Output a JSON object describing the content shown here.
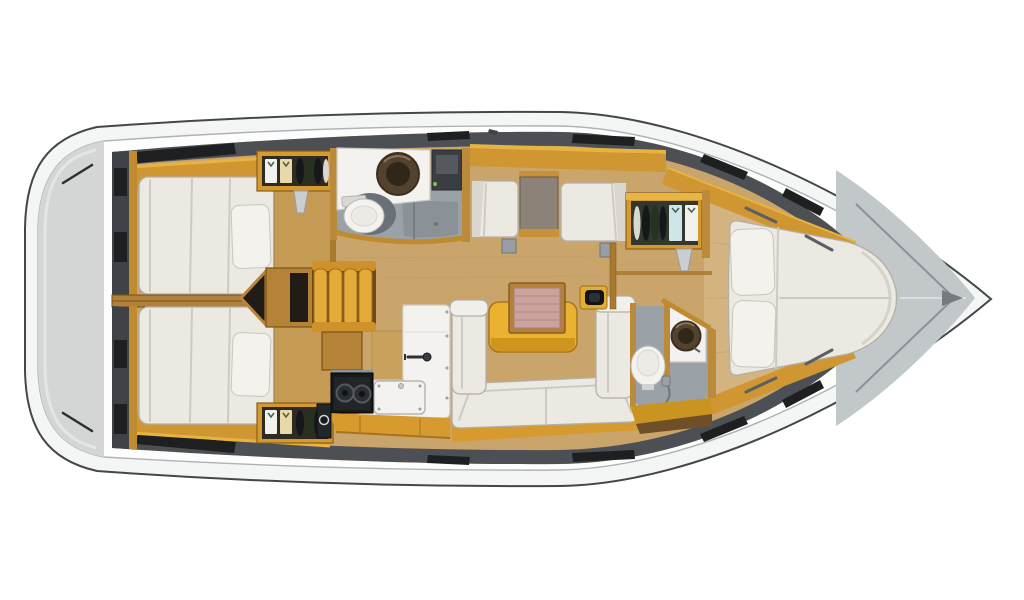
{
  "scene": {
    "subject": "sailboat-interior-floor-plan-top-view",
    "orientation": {
      "bow": "right",
      "stern": "left"
    },
    "rooms": [
      "stern-swim-platform",
      "aft-cabin-port",
      "aft-cabin-starboard",
      "companionway-steps",
      "port-head",
      "nav-station",
      "salon",
      "galley",
      "starboard-head",
      "forward-cabin",
      "anchor-locker"
    ],
    "fixtures": {
      "double_beds": 3,
      "toilets": 2,
      "washbasins": 2,
      "galley_burners": 2,
      "hanging_lockers": 3,
      "saloon_table": 1,
      "nav_seats": 2
    }
  },
  "palette": {
    "page_bg": "#ffffff",
    "deck_band": "#f4f6f5",
    "deck_inner": "#fdfdfd",
    "stern_gray": "#d3d6d5",
    "stern_inner": "#e4e6e5",
    "rail_dark": "#2c2f32",
    "floor_wood": "#c9a56c",
    "floor_wood_light": "#d3b480",
    "floor_seam": "#bf9a5f",
    "bow_gray": "#c2c7c9",
    "bow_line": "#8b9196",
    "bow_center": "#dadedf",
    "bow_tip_dark": "#757b80",
    "side_band": "#4c5054",
    "side_dark_strip": "#3f4347",
    "hatch_black": "#1d1f21",
    "deck_mark": "#5a5f63",
    "shelf_wood": "#cf9631",
    "shelf_bright": "#e9b340",
    "post_wood": "#c08a2f",
    "trim_wood": "#bb8a3a",
    "divider_wood": "#b28038",
    "bulkhead_wood": "#a87a2e",
    "upholstery": "#ebe9e2",
    "upholstery_bright": "#f2f0ea",
    "upholstery_shadow": "#dbd7cf",
    "pillow": "#f4f2ec",
    "wood_shelf_cabin": "#c49a55",
    "cabinet_wood": "#d49a30",
    "cabinet_top": "#e7b544",
    "wardrobe_interior": "#2e2b22",
    "locker_interior": "#34372e",
    "shirt_white": "#f1f1ed",
    "shirt_cream": "#ead9a8",
    "shirt_blue": "#cde6e8",
    "hanger_v": "#46604a",
    "clothes_dark": "#15181a",
    "clothes_green": "#24321f",
    "clothes_light": "#d8d8d2",
    "bracket_gray": "#cbced0",
    "box_wood": "#b58337",
    "box_interior": "#211c15",
    "steps_yellow": "#e5ab3a",
    "steps_cap": "#cf9129",
    "steps_gap": "#6b4a16",
    "head_floor": "#9aa1a7",
    "head_floor_dark": "#8a9197",
    "toilet_shadow": "#6a7077",
    "counter_white": "#f3f2ef",
    "counter_wood_low": "#c9a05c",
    "fixture_dark": "#3a3e42",
    "fixture_light": "#55595e",
    "led_green": "#7bc24a",
    "sink_bowl": "#54422f",
    "sink_inner": "#31261a",
    "sink_highlight": "#8a7357",
    "chart_table": "#8d8278",
    "chart_wood": "#c89137",
    "pedestal_gray": "#989ea3",
    "table_yellow": "#ebb232",
    "table_yellow_dark": "#d0951f",
    "leaf_frame": "#b5813a",
    "leaf_pink": "#cba29c",
    "leaf_line": "#b8918b",
    "minibar_yellow": "#e3ad34",
    "minibar_black": "#121416",
    "minibar_inner": "#2c3136",
    "faucet_dark": "#2e3134",
    "metal": "#8e9499",
    "screw_gray": "#9aa0a5",
    "stove_black": "#17191b",
    "stove_panel": "#222528",
    "burner_ring": "#54595e",
    "burner_inner": "#101214",
    "galley_base": "#d79a2e",
    "base_edge": "#a8731e",
    "dark_item": "#232629",
    "head_base": "#c9941f",
    "base_dark_wood": "#6e4f28"
  }
}
